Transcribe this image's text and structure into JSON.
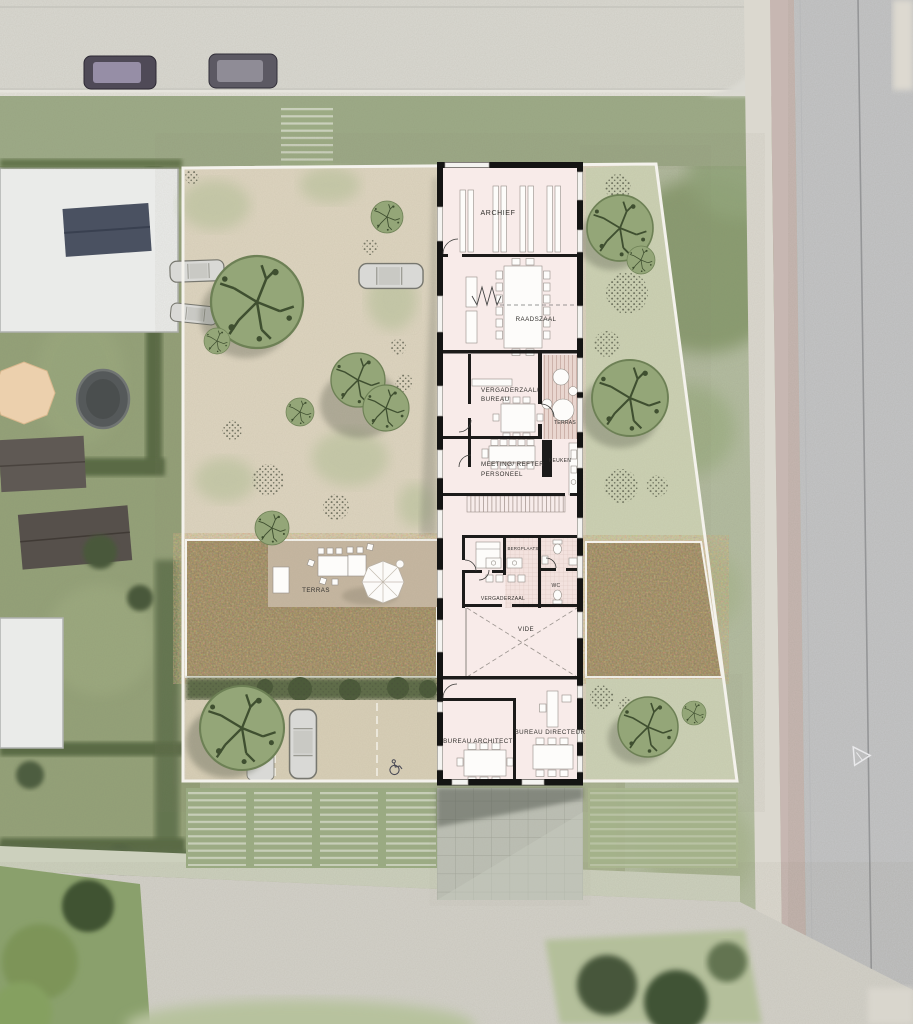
{
  "page": {
    "type": "architectural-site-plan",
    "description": "aerial photo with rendered ground-floor site plan"
  },
  "colors": {
    "building_interior": "#f8ebe9",
    "wall_black": "#141413",
    "site_boundary_white": "#f4f2ec",
    "gravel_garden": "#ded5c0",
    "meadow_brown": "#8d7d5b",
    "terrace_tan": "#c6b7a1",
    "tree_green": "#94a678",
    "plaza_gray": "#bcbfb4",
    "road_asphalt": "#c4c5c7",
    "cycle_path_pink": "#c7b7b2",
    "lawn_green": "#b6c0a3"
  },
  "plan": {
    "labels": {
      "archief": "ARCHIEF",
      "raadszaal": "RAADSZAAL",
      "vergaderzaal_bureau_1": "VERGADERZAAL/",
      "vergaderzaal_bureau_2": "BUREAU",
      "terras_building": "TERRAS",
      "meeting_refter_1": "MEETING/ REFTER",
      "meeting_refter_2": "PERSONEEL",
      "keuken": "KEUKEN",
      "bergplaats": "BERGPLAATS",
      "wc": "WC",
      "vergaderzaal": "VERGADERZAAL",
      "vide": "VIDE",
      "bureau_architect": "BUREAU ARCHITECT",
      "bureau_directeur": "BUREAU DIRECTEUR",
      "terras_garden": "TERRAS"
    }
  }
}
